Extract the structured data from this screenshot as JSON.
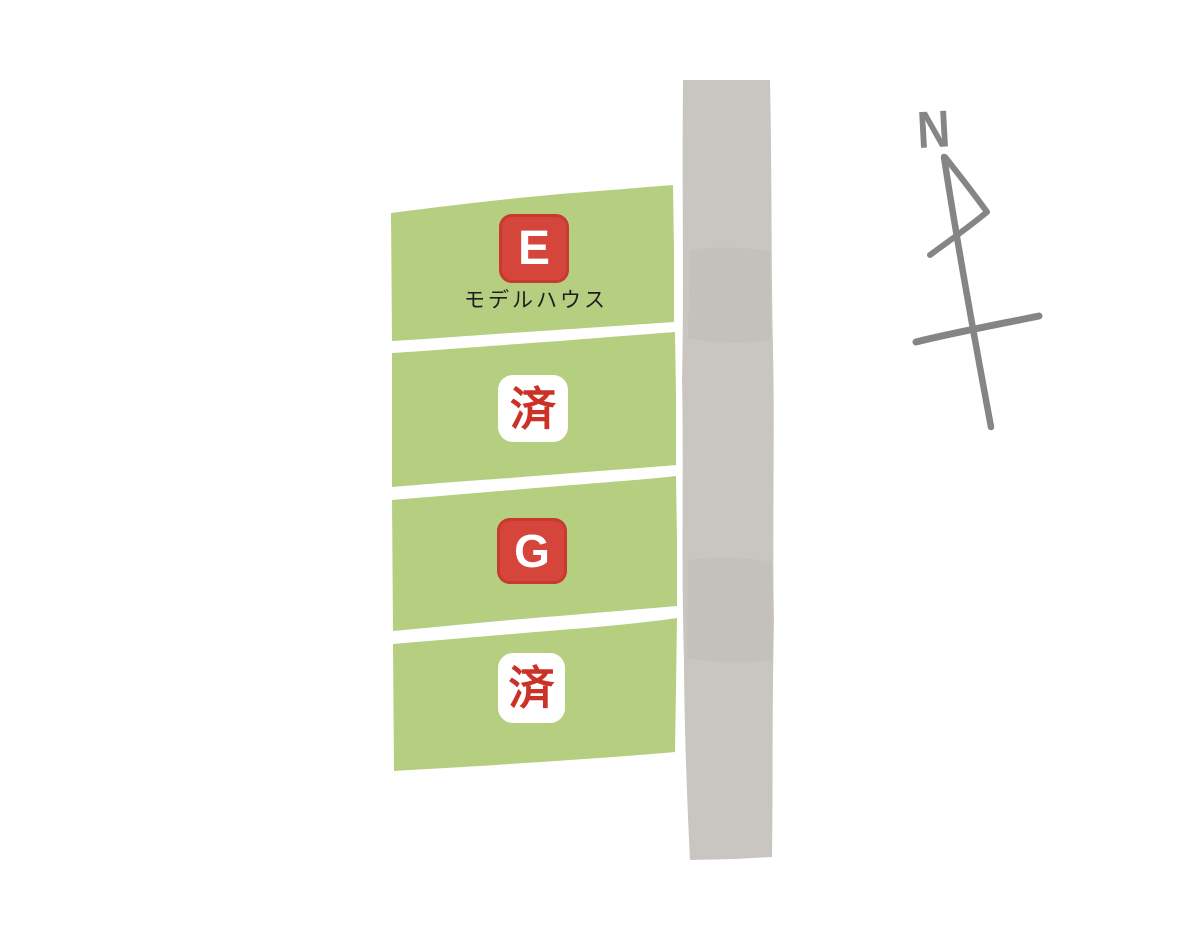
{
  "canvas": {
    "width": 1200,
    "height": 938,
    "background": "#ffffff"
  },
  "lot_map": {
    "parcels": [
      {
        "id": "1",
        "label": "E",
        "caption": "モデルハウス",
        "status": "model-house",
        "badge_style": "red-square"
      },
      {
        "id": "2",
        "label": "済",
        "status": "sold",
        "badge_style": "white-square"
      },
      {
        "id": "3",
        "label": "G",
        "status": "for-sale",
        "badge_style": "red-square"
      },
      {
        "id": "4",
        "label": "済",
        "status": "sold",
        "badge_style": "white-square"
      }
    ],
    "compass": {
      "label": "N",
      "direction": "north-up-tilted"
    }
  },
  "colors": {
    "parcel_green": "#b6ce80",
    "road_gray": "#c9c5c1",
    "badge_red": "#d6453b",
    "badge_red_border": "#a8261e",
    "sold_red": "#cc3127",
    "caption_black": "#1f1f1f",
    "compass_gray": "#858585",
    "badge_white": "#ffffff",
    "background_white": "#ffffff"
  }
}
